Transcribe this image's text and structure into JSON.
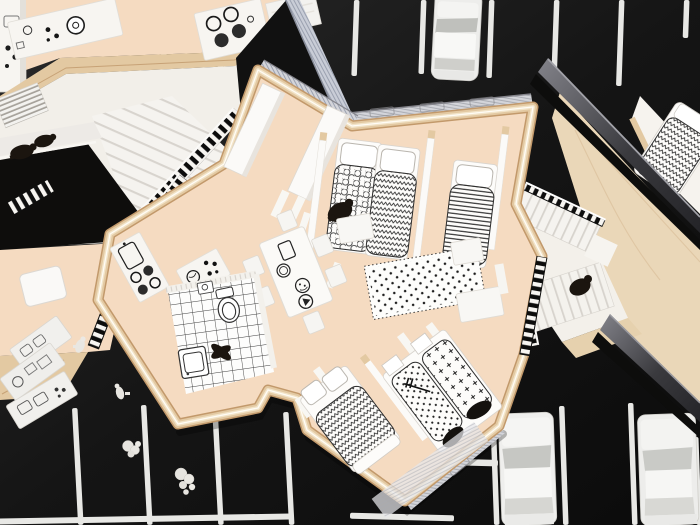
{
  "meta": {
    "domain": "Natural-Image",
    "description": "Overhead photograph of a cardboard architectural scale model: a furnished apartment floor plan between two neighbouring building models, set on a black board painted with white parking-lot stripes, with small white paper cars, loose furniture pieces and black figurines."
  },
  "palette": {
    "line": "#e8e8e5",
    "floor": "#f5dbc1",
    "wood": "#e3c9a2",
    "woodDark": "#bb9164",
    "woodEdge": "#c2996b",
    "white": "#f7f5f1",
    "whiteDim": "#e6e2db",
    "blueWall": "#c9cdd7",
    "greyWall": "#d4d5da",
    "figure": "#1b150f",
    "black": "#0d0d0c"
  },
  "ground": {
    "surface": "black-asphalt-board",
    "markings": "white-parking-stall-lines",
    "stall_lines_top": 10,
    "stall_lines_bottom_left": 4,
    "stall_lines_bottom_right": 4,
    "aisle_lines": 3,
    "cars": [
      {
        "location": "top-center",
        "color": "white"
      },
      {
        "location": "bottom-center",
        "color": "white"
      },
      {
        "location": "bottom-right",
        "color": "white"
      }
    ]
  },
  "apartment": {
    "floor_material": "peach-card",
    "wall_edges": "plywood-laminate",
    "rooms": [
      "entry-hall",
      "bedroom-north-double",
      "bedroom-north-single",
      "living-dining",
      "kitchen",
      "bathroom",
      "bedroom-south-left",
      "bedroom-south-right"
    ],
    "beds": [
      {
        "room": "bedroom-north-double",
        "duvet_pattern": "honeycomb"
      },
      {
        "room": "bedroom-north-double",
        "duvet_pattern": "zigzag"
      },
      {
        "room": "bedroom-north-single",
        "duvet_pattern": "horizontal-stripes"
      },
      {
        "room": "bedroom-south-left",
        "duvet_pattern": "zigzag"
      },
      {
        "room": "bedroom-south-right",
        "duvet_pattern": "dots-with-guitar"
      },
      {
        "room": "bedroom-south-right",
        "duvet_pattern": "crosses"
      }
    ],
    "living": {
      "rug": "white-with-black-polka-dots",
      "table_prints": [
        "tablet",
        "plate",
        "meal-plate",
        "record-player"
      ],
      "chairs": 6,
      "sofa": "white-card-benches"
    },
    "kitchen": [
      "sink-counter",
      "four-burner-hob",
      "worktop-with-plate-and-knobs"
    ],
    "bathroom": [
      "checkered-tile-floor",
      "toilet",
      "washbasin",
      "washing-machine"
    ],
    "entry": [
      "two-white-wardrobes",
      "door-fins"
    ],
    "figures": [
      "black-person-crouching-hallway",
      "black-figure-bathroom-floor"
    ]
  },
  "left_building": {
    "features": [
      "white-kitchen-worktops-with-hob",
      "washing-machine-print",
      "fan-staircase",
      "slatted-balcony-railings",
      "two-black-figurines",
      "small-white-table",
      "striped-floor-grate",
      "tall-white-cabinet"
    ]
  },
  "right_building": {
    "features": [
      "plywood-deck",
      "white-switchback-stair",
      "slatted-railings",
      "black-figurine-on-landing",
      "bedroom-with-zigzag-duvet",
      "grey-acrylic-roof-edges"
    ]
  },
  "loose_items": {
    "white_furniture_pieces": 3,
    "white_figurines": 2,
    "paper_crumbs": 2
  }
}
